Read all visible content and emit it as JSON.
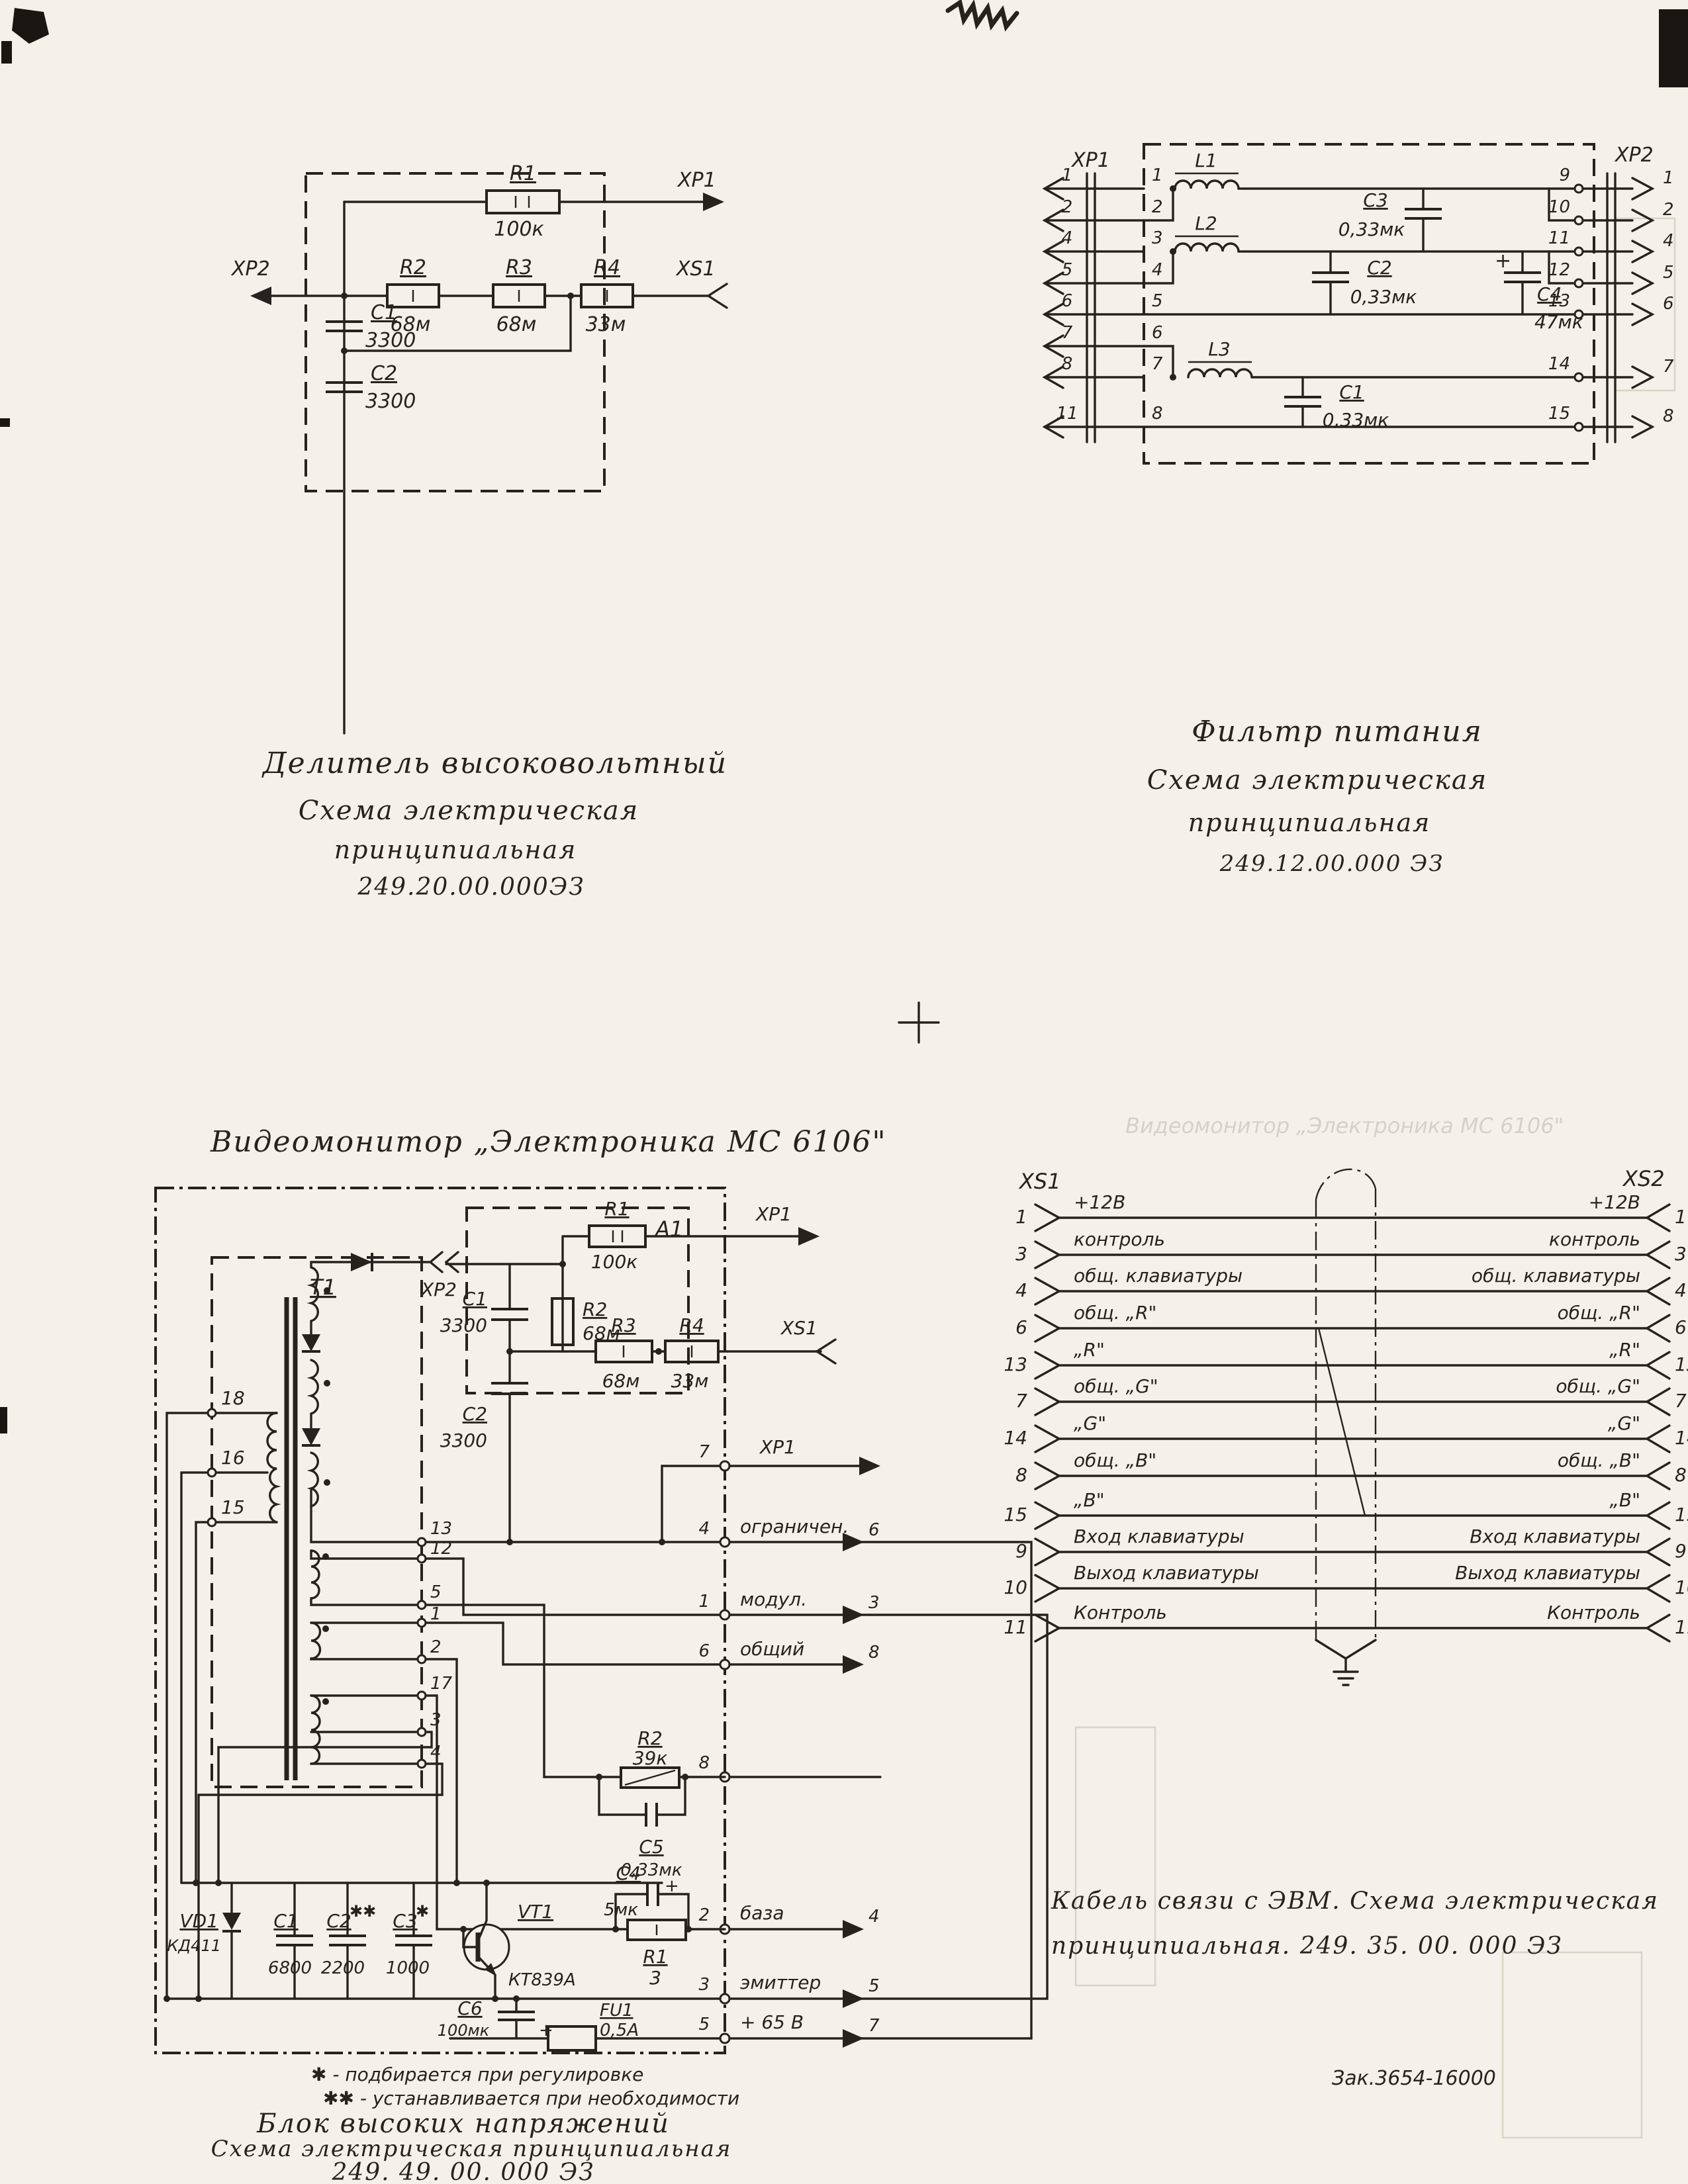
{
  "page": {
    "footer_order_no": "Зак.3654-16000"
  },
  "fig_divider": {
    "connectors": {
      "xp1": "XP1",
      "xp2": "XP2",
      "xs1": "XS1"
    },
    "r1": {
      "ref": "R1",
      "val": "100к"
    },
    "r2": {
      "ref": "R2",
      "val": "68м"
    },
    "r3": {
      "ref": "R3",
      "val": "68м"
    },
    "r4": {
      "ref": "R4",
      "val": "33м"
    },
    "c1": {
      "ref": "C1",
      "val": "3300"
    },
    "c2": {
      "ref": "C2",
      "val": "3300"
    },
    "caption": [
      "Делитель  высоковольтный",
      "Схема  электрическая",
      "принципиальная",
      "249.20.00.000ЭЗ"
    ]
  },
  "fig_filter": {
    "connectors": {
      "xp1": "XP1",
      "xp2": "XP2"
    },
    "l1": "L1",
    "l2": "L2",
    "l3": "L3",
    "c1": {
      "ref": "C1",
      "val": "0,33мк"
    },
    "c2": {
      "ref": "C2",
      "val": "0,33мк"
    },
    "c3": {
      "ref": "C3",
      "val": "0,33мк"
    },
    "c4": {
      "ref": "C4",
      "val": "47мк",
      "plus": "+"
    },
    "left_outer_pins": [
      "1",
      "2",
      "4",
      "5",
      "6",
      "7",
      "8",
      "11"
    ],
    "left_inner_pins": [
      "1",
      "2",
      "3",
      "4",
      "5",
      "6",
      "7",
      "8"
    ],
    "right_inner_pins": [
      "9",
      "10",
      "11",
      "12",
      "13",
      "14",
      "15"
    ],
    "right_outer_pins": [
      "1",
      "2",
      "4",
      "5",
      "6",
      "7",
      "8"
    ],
    "caption": [
      "Фильтр  питания",
      "Схема  электрическая",
      "принципиальная",
      "249.12.00.000 ЭЗ"
    ]
  },
  "fig_hv": {
    "title": "Видеомонитор  „Электроника  МС 6106\"",
    "t1": "T1",
    "a1": {
      "label": "A1",
      "xp1": "XP1",
      "xp2": "XP2",
      "xs1": "XS1",
      "r1": {
        "ref": "R1",
        "val": "100к"
      },
      "r2": {
        "ref": "R2",
        "val": "68м"
      },
      "r3": {
        "ref": "R3",
        "val": "68м"
      },
      "r4": {
        "ref": "R4",
        "val": "33м"
      },
      "c1": {
        "ref": "C1",
        "val": "3300"
      },
      "c2": {
        "ref": "C2",
        "val": "3300"
      }
    },
    "primary_taps": [
      "18",
      "16",
      "15"
    ],
    "sec_pins": [
      "13",
      "12",
      "5",
      "1",
      "2",
      "17",
      "3",
      "4"
    ],
    "vd1": {
      "ref": "VD1",
      "val": "КД411"
    },
    "c1": {
      "ref": "C1",
      "val": "6800"
    },
    "c2": {
      "ref": "C2",
      "val": "2200",
      "mark": "✱✱"
    },
    "c3": {
      "ref": "C3",
      "val": "1000",
      "mark": "✱"
    },
    "vt1": {
      "ref": "VT1",
      "val": "КТ839А"
    },
    "r2": {
      "ref": "R2",
      "val": "39к"
    },
    "c5": {
      "ref": "C5",
      "val": "0,33мк"
    },
    "c4": {
      "ref": "C4",
      "val": "5мк",
      "plus": "+"
    },
    "r1": {
      "ref": "R1",
      "val": "3"
    },
    "c6": {
      "ref": "C6",
      "val": "100мк",
      "plus": "+"
    },
    "fu1": {
      "ref": "FU1",
      "val": "0,5А"
    },
    "border": {
      "p7": {
        "pin": "7",
        "ext": "XP1"
      },
      "p4": {
        "pin": "4",
        "name": "ограничен.",
        "ext": "6"
      },
      "p1": {
        "pin": "1",
        "name": "модул.",
        "ext": "3"
      },
      "p6": {
        "pin": "6",
        "name": "общий",
        "ext": "8"
      },
      "p8": {
        "pin": "8"
      },
      "p2": {
        "pin": "2",
        "name": "база",
        "ext": "4"
      },
      "p3": {
        "pin": "3",
        "name": "эмиттер",
        "ext": "5"
      },
      "p5": {
        "pin": "5",
        "name": "+ 65 В",
        "ext": "7"
      }
    },
    "footnotes": [
      "✱ - подбирается  при  регулировке",
      "✱✱ - устанавливается  при  необходимости"
    ],
    "caption": [
      "Блок  высоких  напряжений",
      "Схема  электрическая  принципиальная",
      "249. 49. 00. 000 ЭЗ"
    ]
  },
  "fig_cable": {
    "left_connector": "XS1",
    "right_connector": "XS2",
    "rows": [
      {
        "lp": "1",
        "ll": "+12В",
        "rl": "+12В",
        "rp": "1"
      },
      {
        "lp": "3",
        "ll": "контроль",
        "rl": "контроль",
        "rp": "3"
      },
      {
        "lp": "4",
        "ll": "общ. клавиатуры",
        "rl": "общ. клавиатуры",
        "rp": "4"
      },
      {
        "lp": "6",
        "ll": "общ. „R\"",
        "rl": "общ. „R\"",
        "rp": "6"
      },
      {
        "lp": "13",
        "ll": "„R\"",
        "rl": "„R\"",
        "rp": "13"
      },
      {
        "lp": "7",
        "ll": "общ. „G\"",
        "rl": "общ. „G\"",
        "rp": "7"
      },
      {
        "lp": "14",
        "ll": "„G\"",
        "rl": "„G\"",
        "rp": "14"
      },
      {
        "lp": "8",
        "ll": "общ. „В\"",
        "rl": "общ. „В\"",
        "rp": "8"
      },
      {
        "lp": "15",
        "ll": "„В\"",
        "rl": "„В\"",
        "rp": "15"
      },
      {
        "lp": "9",
        "ll": "Вход клавиатуры",
        "rl": "Вход клавиатуры",
        "rp": "9"
      },
      {
        "lp": "10",
        "ll": "Выход клавиатуры",
        "rl": "Выход клавиатуры",
        "rp": "10"
      },
      {
        "lp": "11",
        "ll": "Контроль",
        "rl": "Контроль",
        "rp": "11"
      }
    ],
    "caption": [
      "Кабель  связи  с  ЭВМ.     Схема  электрическая",
      "принципиальная.     249. 35. 00. 000 ЭЗ"
    ]
  },
  "ghost": {
    "title": "Видеомонитор  „Электроника  МС 6106\""
  }
}
